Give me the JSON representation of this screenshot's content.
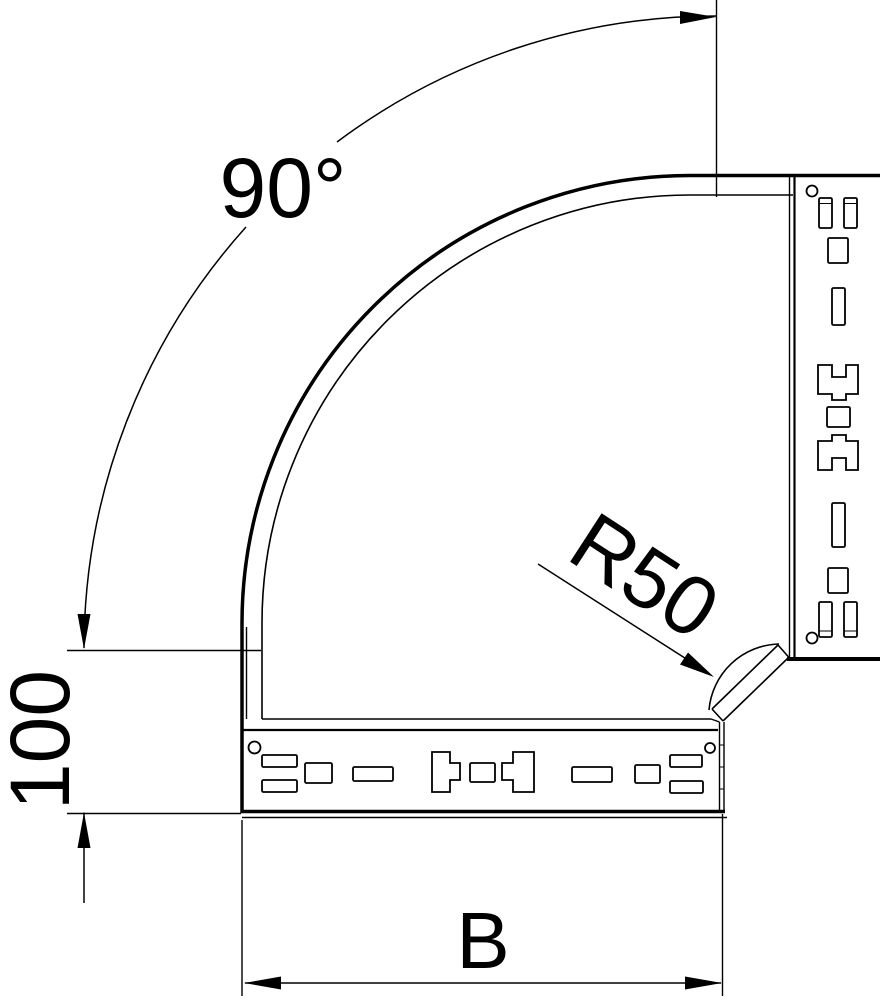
{
  "page": {
    "background": "#ffffff"
  },
  "drawing": {
    "line_color": "#000000",
    "labels": {
      "angle": "90°",
      "radius": "R50",
      "height": "100",
      "width": "B"
    }
  }
}
